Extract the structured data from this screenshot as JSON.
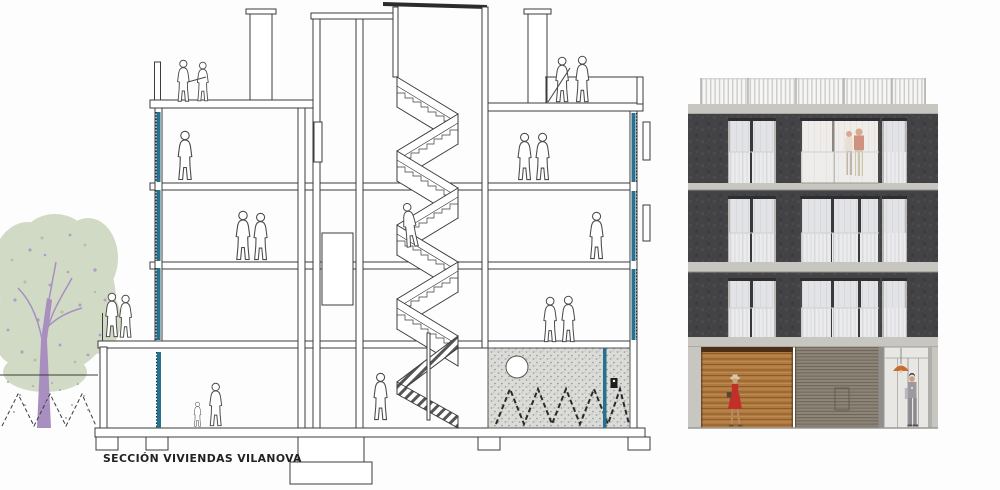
{
  "caption": "SECCIÓN VIVIENDAS VILANOVA",
  "palette": {
    "line": "#3c3c3c",
    "glazing_teal": "#26718f",
    "basement_gray": "#dbdbd8",
    "tree_foliage": "#cfd9c3",
    "tree_purple": "#b49cc8",
    "tree_trunk": "#a88fc0",
    "facade_wall": "#434245",
    "concrete_band": "#c8c6c0",
    "window_pane": "#e2e3e7",
    "wood_door": "#b0793f",
    "louver_panel": "#8d8577",
    "entry_glass": "#e9e7e3",
    "lamp_orange": "#c96b35",
    "dress_red": "#c03028",
    "suit_gray": "#9b9aa1"
  }
}
